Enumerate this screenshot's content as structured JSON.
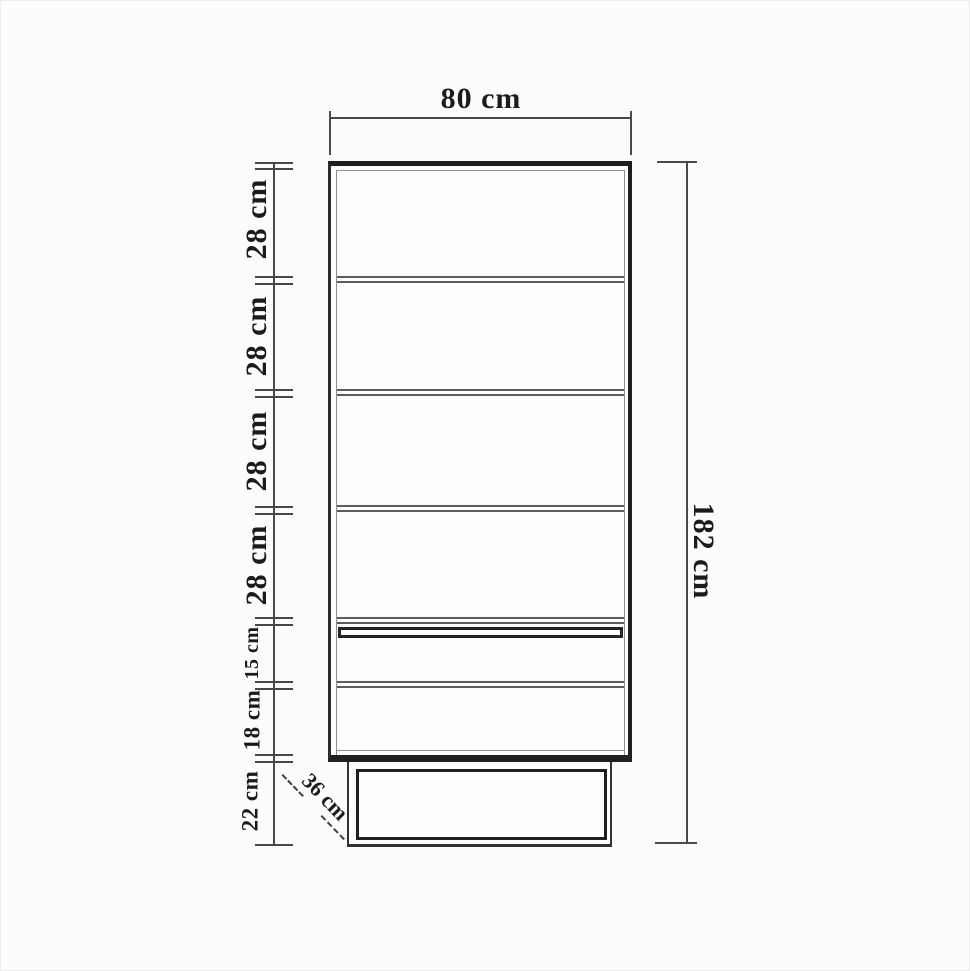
{
  "drawing": {
    "type": "furniture-dimension-diagram",
    "width_label": "80 cm",
    "height_label": "182 cm",
    "depth_label": "36 cm",
    "left_sections": [
      "28 cm",
      "28 cm",
      "28 cm",
      "28 cm",
      "15 cm",
      "18 cm",
      "22 cm"
    ]
  },
  "colors": {
    "background": "#fcfcfc",
    "line_dark": "#1f1f1f",
    "line_mid": "#4a4a4a",
    "line_light": "#8f8f8f",
    "text": "#1b1b1b"
  }
}
